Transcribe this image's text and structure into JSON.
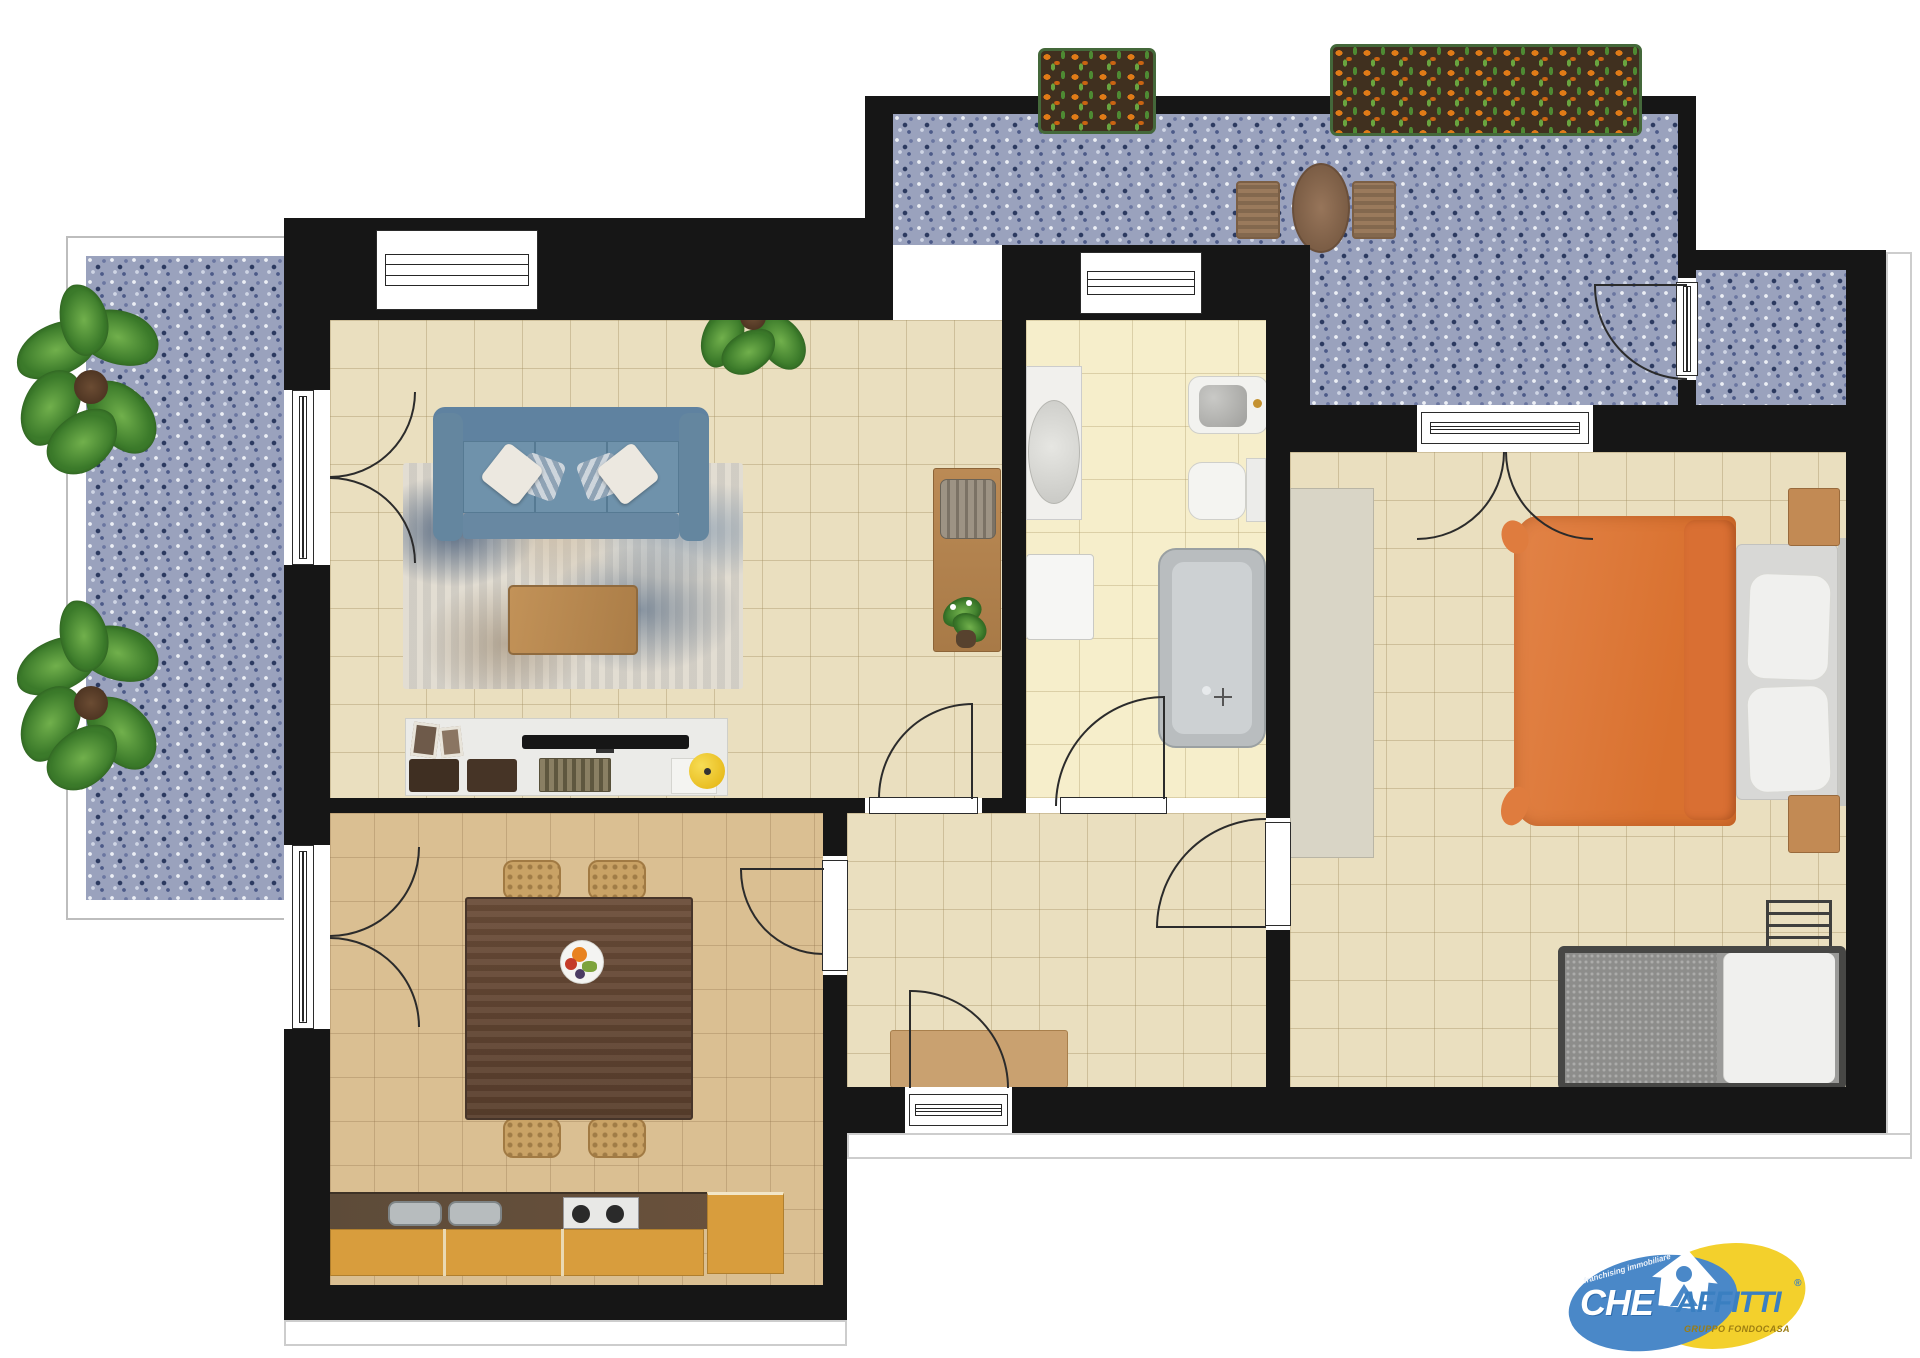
{
  "document": {
    "type": "apartment floor plan, furnished top view",
    "wall_color": "#161616",
    "background": "#ffffff"
  },
  "rooms": [
    {
      "name": "living-room",
      "floor": "beige tile",
      "items": [
        "3-seat blue sofa",
        "abstract blue-beige rug",
        "wood coffee table",
        "white tv-sideboard",
        "tv",
        "picture frames",
        "desk",
        "desk chair",
        "large potted plant"
      ]
    },
    {
      "name": "dining-kitchen",
      "floor": "tan tile",
      "items": [
        "dark wood dining table",
        "4 wicker chairs",
        "fruit bowl",
        "kitchen counter",
        "double sink",
        "2-burner hob",
        "yellow base cabinets",
        "tall cabinet"
      ]
    },
    {
      "name": "bathroom",
      "floor": "cream tile",
      "items": [
        "vanity with oval sink",
        "washing machine",
        "bidet",
        "toilet",
        "bathtub"
      ]
    },
    {
      "name": "bedroom",
      "floor": "beige tile",
      "items": [
        "double bed with orange duvet",
        "two pillows",
        "wardrobe",
        "2 wood nightstands",
        "single bed with gray blanket",
        "radiator"
      ]
    },
    {
      "name": "hallway",
      "floor": "beige tile",
      "items": [
        "console table",
        "entrance door"
      ]
    },
    {
      "name": "balcony-left",
      "floor": "blue mosaic tile",
      "items": [
        "large plant",
        "large plant"
      ]
    },
    {
      "name": "terrace-top",
      "floor": "blue mosaic tile",
      "items": [
        "round wood table",
        "2 slat chairs",
        "flower box",
        "flower box",
        "storage room"
      ]
    }
  ],
  "palette": {
    "wall": "#161616",
    "beige_floor": "#eadfbf",
    "cream_floor": "#f6eecb",
    "tan_floor": "#dabf92",
    "mosaic_blue": "#9aa2bd",
    "sofa_blue": "#6f92ab",
    "bed_orange": "#e07a3c",
    "kitchen_yellow": "#d89d3d",
    "logo_blue": "#4a88c8",
    "logo_yellow": "#f3d02c"
  },
  "logo": {
    "word1": "CHE",
    "word2": "AFFITTI",
    "registered": "®",
    "subtitle": "GRUPPO FONDOCASA",
    "ribbon": "franchising immobiliare"
  }
}
